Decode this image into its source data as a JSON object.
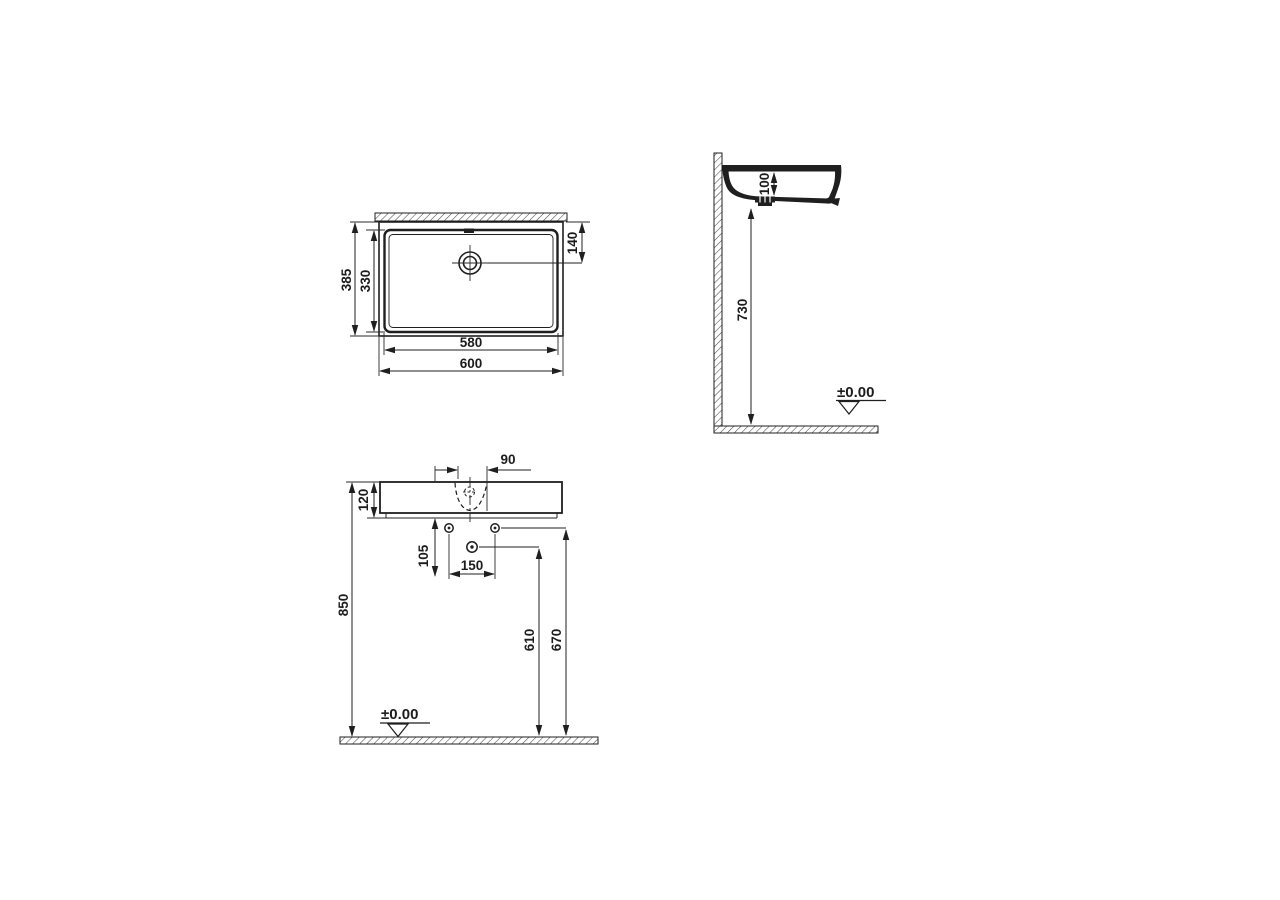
{
  "drawing": {
    "ink_color": "#1f1f1f",
    "background_color": "#ffffff",
    "top_view": {
      "outer_width": "600",
      "inner_width": "580",
      "outer_depth": "385",
      "inner_depth": "330",
      "drain_offset": "140"
    },
    "side_view": {
      "basin_depth": "100",
      "clearance_height": "730",
      "floor_level": "±0.00"
    },
    "front_view": {
      "tap_recess_width": "90",
      "rim_height": "120",
      "drain_drop": "105",
      "hole_spacing": "150",
      "overall_height": "850",
      "drain_height": "610",
      "hole_height": "670",
      "floor_level": "±0.00"
    }
  }
}
